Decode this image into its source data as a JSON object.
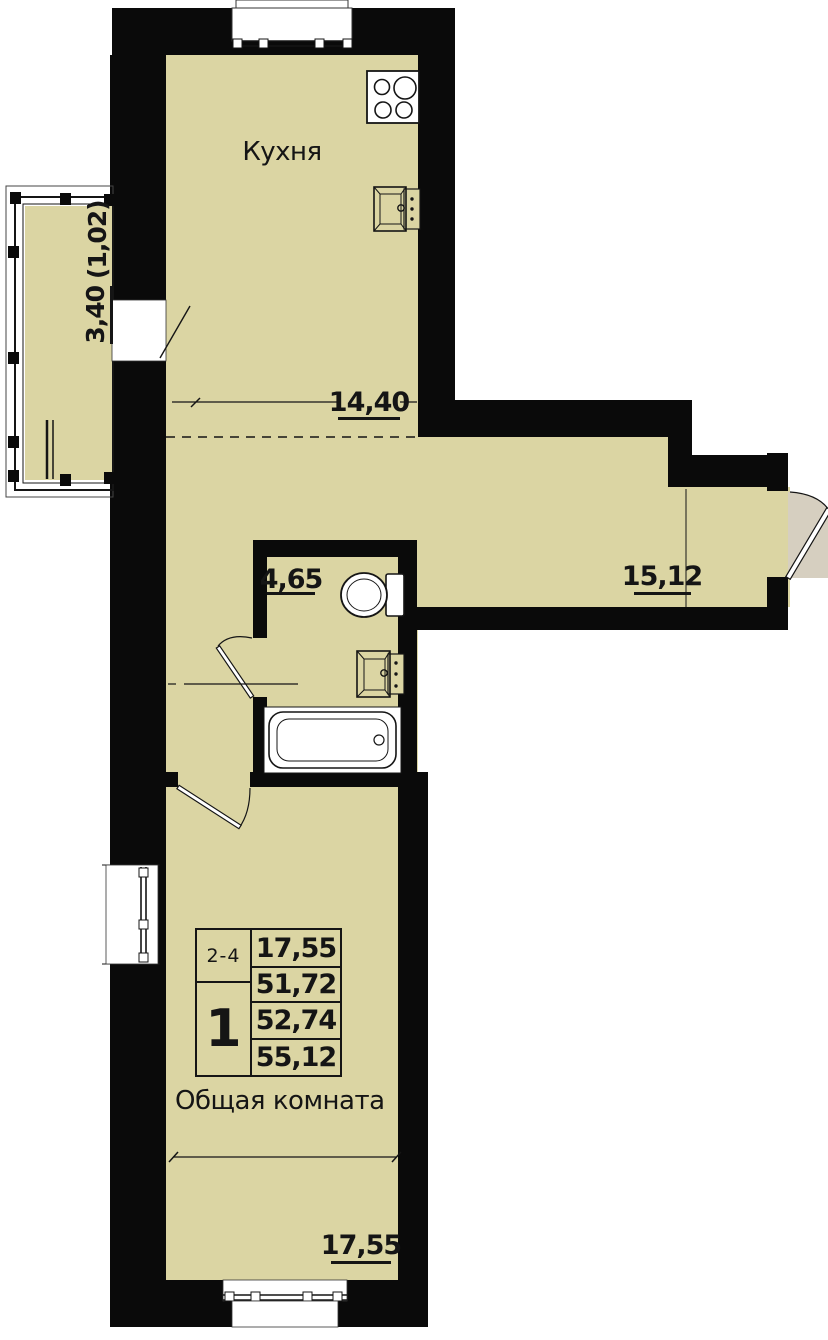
{
  "floor_plan": {
    "rooms": {
      "kitchen": {
        "label": "Кухня",
        "dimension": "14,40"
      },
      "living_room": {
        "label": "Общая комната",
        "dimension": "17,55"
      },
      "bathroom": {
        "dimension": "4,65"
      },
      "hallway": {
        "dimension": "15,12"
      },
      "balcony": {
        "dimension_main": "3,40",
        "dimension_paren": "(1,02)"
      }
    },
    "info_table": {
      "floors_label": "2-4",
      "rooms_count": "1",
      "areas": [
        "17,55",
        "51,72",
        "52,74",
        "55,12"
      ]
    },
    "colors": {
      "room_fill": "#dbd5a3",
      "wall": "#0a0a0a",
      "door_swing_fill": "#d6cfc0",
      "line": "#151515"
    }
  }
}
